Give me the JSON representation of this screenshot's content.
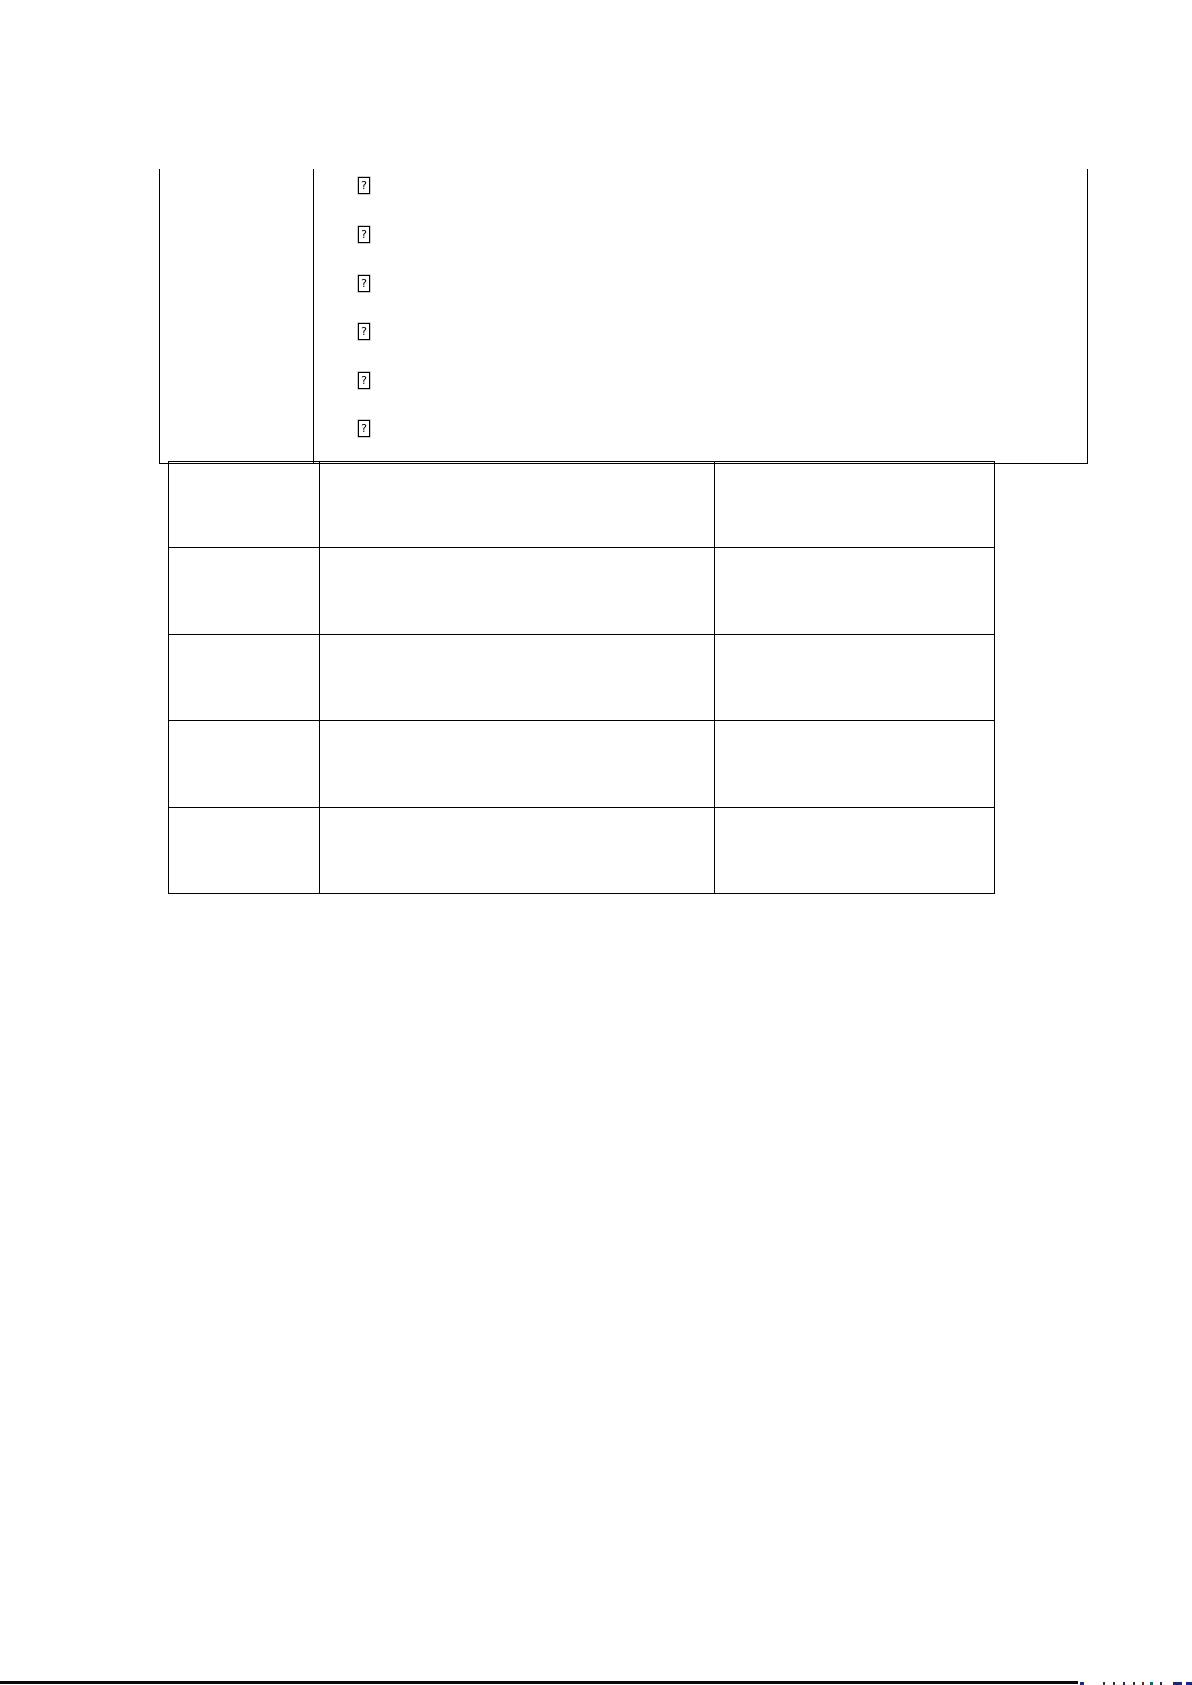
{
  "page": {
    "background": "#ffffff"
  },
  "top_table": {
    "glyph_char": "?",
    "glyph_count": 6,
    "left_cell_text": "",
    "right_cell_text": ""
  },
  "bottom_table": {
    "rows": 5,
    "cols": 3,
    "cells": [
      [
        "",
        "",
        ""
      ],
      [
        "",
        "",
        ""
      ],
      [
        "",
        "",
        ""
      ],
      [
        "",
        "",
        ""
      ],
      [
        "",
        "",
        ""
      ]
    ]
  },
  "bottom_bar": {
    "rule_color": "#0a0a0a",
    "specks": [
      {
        "x": 1080,
        "w": 4,
        "color": "#1b2a7e"
      },
      {
        "x": 1103,
        "w": 2,
        "color": "#333333"
      },
      {
        "x": 1113,
        "w": 2,
        "color": "#333333"
      },
      {
        "x": 1123,
        "w": 2,
        "color": "#2a2a4a"
      },
      {
        "x": 1133,
        "w": 2,
        "color": "#333333"
      },
      {
        "x": 1142,
        "w": 2,
        "color": "#5a2a2a"
      },
      {
        "x": 1150,
        "w": 3,
        "color": "#0e6b63"
      },
      {
        "x": 1160,
        "w": 2,
        "color": "#2a2a4a"
      },
      {
        "x": 1173,
        "w": 9,
        "color": "#1b2a7e"
      },
      {
        "x": 1186,
        "w": 6,
        "color": "#1b2a7e"
      }
    ]
  },
  "colors": {
    "table_border": "#000000"
  }
}
